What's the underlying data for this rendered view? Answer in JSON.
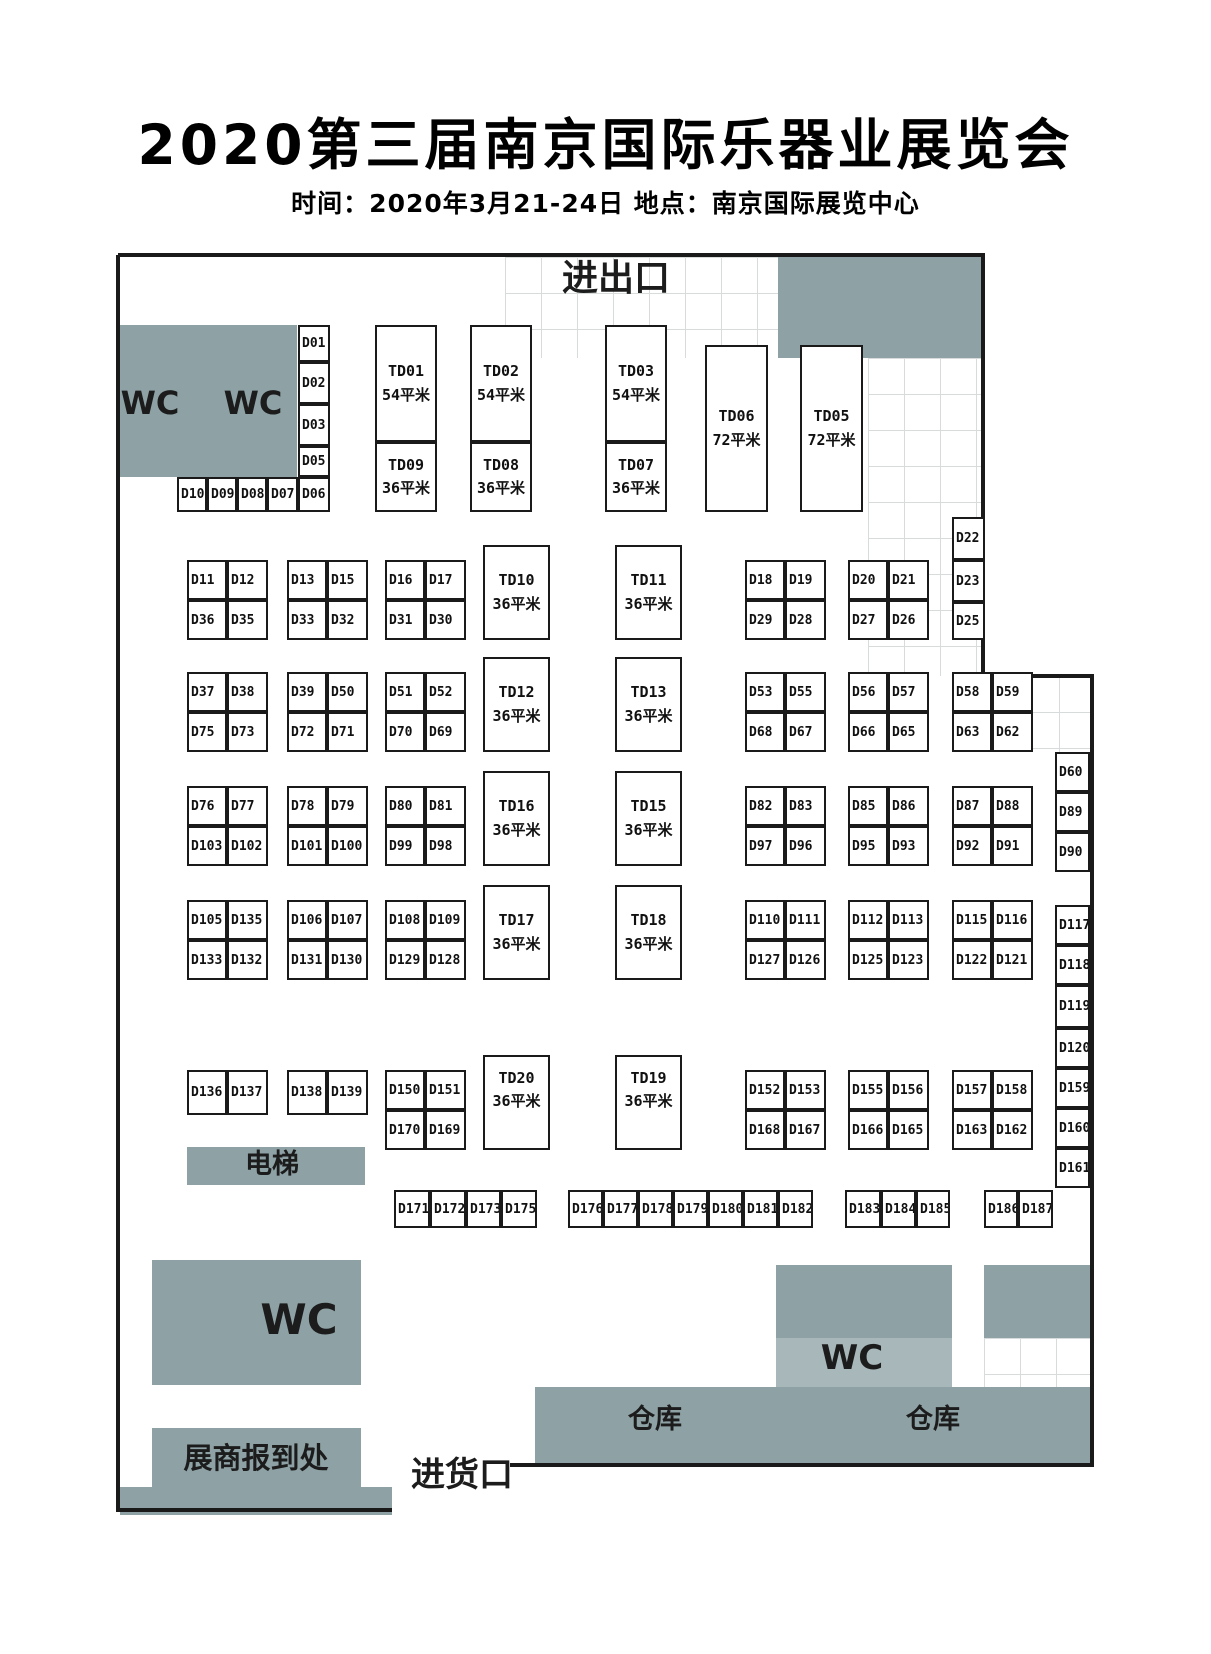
{
  "title": "2020第三届南京国际乐器业展览会",
  "subtitle": "时间：2020年3月21-24日  地点：南京国际展览中心",
  "labels": {
    "entrance": "进出口",
    "wc": "WC",
    "elevator": "电梯",
    "warehouse": "仓库",
    "registration": "展商报到处",
    "goods": "进货口"
  },
  "texts": [
    {
      "name": "entrance-label",
      "key": "entrance",
      "cx": 616,
      "cy": 281,
      "fs": 36
    },
    {
      "name": "wc-top-left-label-1",
      "key": "wc",
      "cx": 150,
      "cy": 405,
      "fs": 32
    },
    {
      "name": "wc-top-left-label-2",
      "key": "wc",
      "cx": 253,
      "cy": 405,
      "fs": 32
    },
    {
      "name": "wc-bottom-left-label",
      "key": "wc",
      "cx": 299,
      "cy": 1322,
      "fs": 42
    },
    {
      "name": "wc-bottom-right-label",
      "key": "wc",
      "cx": 852,
      "cy": 1360,
      "fs": 34
    },
    {
      "name": "elevator-label",
      "key": "elevator",
      "cx": 272,
      "cy": 1166,
      "fs": 27
    },
    {
      "name": "warehouse-label-1",
      "key": "warehouse",
      "cx": 655,
      "cy": 1421,
      "fs": 27
    },
    {
      "name": "warehouse-label-2",
      "key": "warehouse",
      "cx": 933,
      "cy": 1421,
      "fs": 27
    },
    {
      "name": "registration-label",
      "key": "registration",
      "cx": 256,
      "cy": 1460,
      "fs": 29
    },
    {
      "name": "goods-entrance-label",
      "key": "goods",
      "cx": 462,
      "cy": 1477,
      "fs": 34
    }
  ],
  "areas": [
    {
      "name": "area-wc-top-left",
      "x": 120,
      "y": 325,
      "w": 177,
      "h": 152,
      "shade": "main"
    },
    {
      "name": "area-top-right",
      "x": 778,
      "y": 257,
      "w": 205,
      "h": 101,
      "shade": "main"
    },
    {
      "name": "area-elevator",
      "x": 187,
      "y": 1147,
      "w": 178,
      "h": 38,
      "shade": "main"
    },
    {
      "name": "area-wc-bottom-left",
      "x": 152,
      "y": 1260,
      "w": 209,
      "h": 125,
      "shade": "main"
    },
    {
      "name": "area-wc-bottom-right",
      "x": 776,
      "y": 1265,
      "w": 176,
      "h": 73,
      "shade": "main"
    },
    {
      "name": "area-wc-bottom-right-light",
      "x": 776,
      "y": 1338,
      "w": 176,
      "h": 49,
      "shade": "light"
    },
    {
      "name": "area-grey-right",
      "x": 984,
      "y": 1265,
      "w": 106,
      "h": 73,
      "shade": "main"
    },
    {
      "name": "area-warehouse",
      "x": 535,
      "y": 1387,
      "w": 555,
      "h": 78,
      "shade": "main"
    },
    {
      "name": "area-registration",
      "x": 152,
      "y": 1428,
      "w": 209,
      "h": 67,
      "shade": "main"
    },
    {
      "name": "area-bottom-left-strip",
      "x": 120,
      "y": 1487,
      "w": 272,
      "h": 28,
      "shade": "main"
    }
  ],
  "grids": [
    {
      "x": 505,
      "y": 257,
      "w": 273,
      "h": 101
    },
    {
      "x": 868,
      "y": 358,
      "w": 115,
      "h": 318
    },
    {
      "x": 1023,
      "y": 676,
      "w": 69,
      "h": 76
    },
    {
      "x": 984,
      "y": 1338,
      "w": 106,
      "h": 49
    }
  ],
  "booths": [
    {
      "id": "D01",
      "x": 298,
      "y": 325,
      "w": 32,
      "h": 37
    },
    {
      "id": "D02",
      "x": 298,
      "y": 362,
      "w": 32,
      "h": 42
    },
    {
      "id": "D03",
      "x": 298,
      "y": 404,
      "w": 32,
      "h": 42
    },
    {
      "id": "D05",
      "x": 298,
      "y": 446,
      "w": 32,
      "h": 31
    },
    {
      "id": "D06",
      "x": 298,
      "y": 477,
      "w": 32,
      "h": 35
    },
    {
      "id": "D10",
      "x": 177,
      "y": 477,
      "w": 30,
      "h": 35
    },
    {
      "id": "D09",
      "x": 207,
      "y": 477,
      "w": 30,
      "h": 35
    },
    {
      "id": "D08",
      "x": 237,
      "y": 477,
      "w": 30,
      "h": 35
    },
    {
      "id": "D07",
      "x": 267,
      "y": 477,
      "w": 31,
      "h": 35
    },
    {
      "id": "D22",
      "x": 952,
      "y": 517,
      "w": 33,
      "h": 43
    },
    {
      "id": "D23",
      "x": 952,
      "y": 560,
      "w": 33,
      "h": 42
    },
    {
      "id": "D25",
      "x": 952,
      "y": 602,
      "w": 33,
      "h": 38
    },
    {
      "id": "D60",
      "x": 1055,
      "y": 752,
      "w": 35,
      "h": 40
    },
    {
      "id": "D89",
      "x": 1055,
      "y": 792,
      "w": 35,
      "h": 40
    },
    {
      "id": "D90",
      "x": 1055,
      "y": 832,
      "w": 35,
      "h": 40
    },
    {
      "id": "D117",
      "x": 1055,
      "y": 905,
      "w": 35,
      "h": 40
    },
    {
      "id": "D118",
      "x": 1055,
      "y": 945,
      "w": 35,
      "h": 40
    },
    {
      "id": "D119",
      "x": 1055,
      "y": 985,
      "w": 35,
      "h": 43
    },
    {
      "id": "D120",
      "x": 1055,
      "y": 1028,
      "w": 35,
      "h": 40
    },
    {
      "id": "D159",
      "x": 1055,
      "y": 1068,
      "w": 35,
      "h": 40
    },
    {
      "id": "D160",
      "x": 1055,
      "y": 1108,
      "w": 35,
      "h": 40
    },
    {
      "id": "D161",
      "x": 1055,
      "y": 1148,
      "w": 35,
      "h": 40
    },
    {
      "id": "D136",
      "x": 187,
      "y": 1070,
      "w": 40,
      "h": 45
    },
    {
      "id": "D137",
      "x": 227,
      "y": 1070,
      "w": 41,
      "h": 45
    },
    {
      "id": "D138",
      "x": 287,
      "y": 1070,
      "w": 40,
      "h": 45
    },
    {
      "id": "D139",
      "x": 327,
      "y": 1070,
      "w": 41,
      "h": 45
    },
    {
      "id": "D171",
      "x": 394,
      "y": 1190,
      "w": 36,
      "h": 38
    },
    {
      "id": "D172",
      "x": 430,
      "y": 1190,
      "w": 36,
      "h": 38
    },
    {
      "id": "D173",
      "x": 466,
      "y": 1190,
      "w": 35,
      "h": 38
    },
    {
      "id": "D175",
      "x": 501,
      "y": 1190,
      "w": 36,
      "h": 38
    },
    {
      "id": "D176",
      "x": 568,
      "y": 1190,
      "w": 35,
      "h": 38
    },
    {
      "id": "D177",
      "x": 603,
      "y": 1190,
      "w": 35,
      "h": 38
    },
    {
      "id": "D178",
      "x": 638,
      "y": 1190,
      "w": 35,
      "h": 38
    },
    {
      "id": "D179",
      "x": 673,
      "y": 1190,
      "w": 35,
      "h": 38
    },
    {
      "id": "D180",
      "x": 708,
      "y": 1190,
      "w": 35,
      "h": 38
    },
    {
      "id": "D181",
      "x": 743,
      "y": 1190,
      "w": 35,
      "h": 38
    },
    {
      "id": "D182",
      "x": 778,
      "y": 1190,
      "w": 35,
      "h": 38
    },
    {
      "id": "D183",
      "x": 845,
      "y": 1190,
      "w": 36,
      "h": 38
    },
    {
      "id": "D184",
      "x": 881,
      "y": 1190,
      "w": 35,
      "h": 38
    },
    {
      "id": "D185",
      "x": 916,
      "y": 1190,
      "w": 34,
      "h": 38
    },
    {
      "id": "D186",
      "x": 984,
      "y": 1190,
      "w": 34,
      "h": 38
    },
    {
      "id": "D187",
      "x": 1018,
      "y": 1190,
      "w": 35,
      "h": 38
    }
  ],
  "blocks": [
    {
      "x": 187,
      "y": 560,
      "cells": [
        "D11",
        "D12",
        "D36",
        "D35"
      ]
    },
    {
      "x": 287,
      "y": 560,
      "cells": [
        "D13",
        "D15",
        "D33",
        "D32"
      ]
    },
    {
      "x": 385,
      "y": 560,
      "cells": [
        "D16",
        "D17",
        "D31",
        "D30"
      ]
    },
    {
      "x": 745,
      "y": 560,
      "cells": [
        "D18",
        "D19",
        "D29",
        "D28"
      ]
    },
    {
      "x": 848,
      "y": 560,
      "cells": [
        "D20",
        "D21",
        "D27",
        "D26"
      ]
    },
    {
      "x": 187,
      "y": 672,
      "cells": [
        "D37",
        "D38",
        "D75",
        "D73"
      ]
    },
    {
      "x": 287,
      "y": 672,
      "cells": [
        "D39",
        "D50",
        "D72",
        "D71"
      ]
    },
    {
      "x": 385,
      "y": 672,
      "cells": [
        "D51",
        "D52",
        "D70",
        "D69"
      ]
    },
    {
      "x": 745,
      "y": 672,
      "cells": [
        "D53",
        "D55",
        "D68",
        "D67"
      ]
    },
    {
      "x": 848,
      "y": 672,
      "cells": [
        "D56",
        "D57",
        "D66",
        "D65"
      ]
    },
    {
      "x": 952,
      "y": 672,
      "cells": [
        "D58",
        "D59",
        "D63",
        "D62"
      ]
    },
    {
      "x": 187,
      "y": 786,
      "cells": [
        "D76",
        "D77",
        "D103",
        "D102"
      ]
    },
    {
      "x": 287,
      "y": 786,
      "cells": [
        "D78",
        "D79",
        "D101",
        "D100"
      ]
    },
    {
      "x": 385,
      "y": 786,
      "cells": [
        "D80",
        "D81",
        "D99",
        "D98"
      ]
    },
    {
      "x": 745,
      "y": 786,
      "cells": [
        "D82",
        "D83",
        "D97",
        "D96"
      ]
    },
    {
      "x": 848,
      "y": 786,
      "cells": [
        "D85",
        "D86",
        "D95",
        "D93"
      ]
    },
    {
      "x": 952,
      "y": 786,
      "cells": [
        "D87",
        "D88",
        "D92",
        "D91"
      ]
    },
    {
      "x": 187,
      "y": 900,
      "cells": [
        "D105",
        "D135",
        "D133",
        "D132"
      ]
    },
    {
      "x": 287,
      "y": 900,
      "cells": [
        "D106",
        "D107",
        "D131",
        "D130"
      ]
    },
    {
      "x": 385,
      "y": 900,
      "cells": [
        "D108",
        "D109",
        "D129",
        "D128"
      ]
    },
    {
      "x": 745,
      "y": 900,
      "cells": [
        "D110",
        "D111",
        "D127",
        "D126"
      ]
    },
    {
      "x": 848,
      "y": 900,
      "cells": [
        "D112",
        "D113",
        "D125",
        "D123"
      ]
    },
    {
      "x": 952,
      "y": 900,
      "cells": [
        "D115",
        "D116",
        "D122",
        "D121"
      ]
    },
    {
      "x": 385,
      "y": 1070,
      "cells": [
        "D150",
        "D151",
        "D170",
        "D169"
      ]
    },
    {
      "x": 745,
      "y": 1070,
      "cells": [
        "D152",
        "D153",
        "D168",
        "D167"
      ]
    },
    {
      "x": 848,
      "y": 1070,
      "cells": [
        "D155",
        "D156",
        "D166",
        "D165"
      ]
    },
    {
      "x": 952,
      "y": 1070,
      "cells": [
        "D157",
        "D158",
        "D163",
        "D162"
      ]
    }
  ],
  "td_booths": [
    {
      "id": "TD01",
      "size": "54平米",
      "x": 375,
      "y": 325,
      "w": 62,
      "h": 117
    },
    {
      "id": "TD02",
      "size": "54平米",
      "x": 470,
      "y": 325,
      "w": 62,
      "h": 117
    },
    {
      "id": "TD03",
      "size": "54平米",
      "x": 605,
      "y": 325,
      "w": 62,
      "h": 117
    },
    {
      "id": "TD09",
      "size": "36平米",
      "x": 375,
      "y": 442,
      "w": 62,
      "h": 70
    },
    {
      "id": "TD08",
      "size": "36平米",
      "x": 470,
      "y": 442,
      "w": 62,
      "h": 70
    },
    {
      "id": "TD07",
      "size": "36平米",
      "x": 605,
      "y": 442,
      "w": 62,
      "h": 70
    },
    {
      "id": "TD06",
      "size": "72平米",
      "x": 705,
      "y": 345,
      "w": 63,
      "h": 167
    },
    {
      "id": "TD05",
      "size": "72平米",
      "x": 800,
      "y": 345,
      "w": 63,
      "h": 167
    },
    {
      "id": "TD10",
      "size": "36平米",
      "x": 483,
      "y": 545,
      "w": 67,
      "h": 95
    },
    {
      "id": "TD11",
      "size": "36平米",
      "x": 615,
      "y": 545,
      "w": 67,
      "h": 95
    },
    {
      "id": "TD12",
      "size": "36平米",
      "x": 483,
      "y": 657,
      "w": 67,
      "h": 95
    },
    {
      "id": "TD13",
      "size": "36平米",
      "x": 615,
      "y": 657,
      "w": 67,
      "h": 95
    },
    {
      "id": "TD16",
      "size": "36平米",
      "x": 483,
      "y": 771,
      "w": 67,
      "h": 95
    },
    {
      "id": "TD15",
      "size": "36平米",
      "x": 615,
      "y": 771,
      "w": 67,
      "h": 95
    },
    {
      "id": "TD17",
      "size": "36平米",
      "x": 483,
      "y": 885,
      "w": 67,
      "h": 95
    },
    {
      "id": "TD18",
      "size": "36平米",
      "x": 615,
      "y": 885,
      "w": 67,
      "h": 95
    },
    {
      "id": "TD20",
      "size": "36平米",
      "x": 483,
      "y": 1055,
      "w": 67,
      "h": 95,
      "top": true
    },
    {
      "id": "TD19",
      "size": "36平米",
      "x": 615,
      "y": 1055,
      "w": 67,
      "h": 95,
      "top": true
    }
  ]
}
